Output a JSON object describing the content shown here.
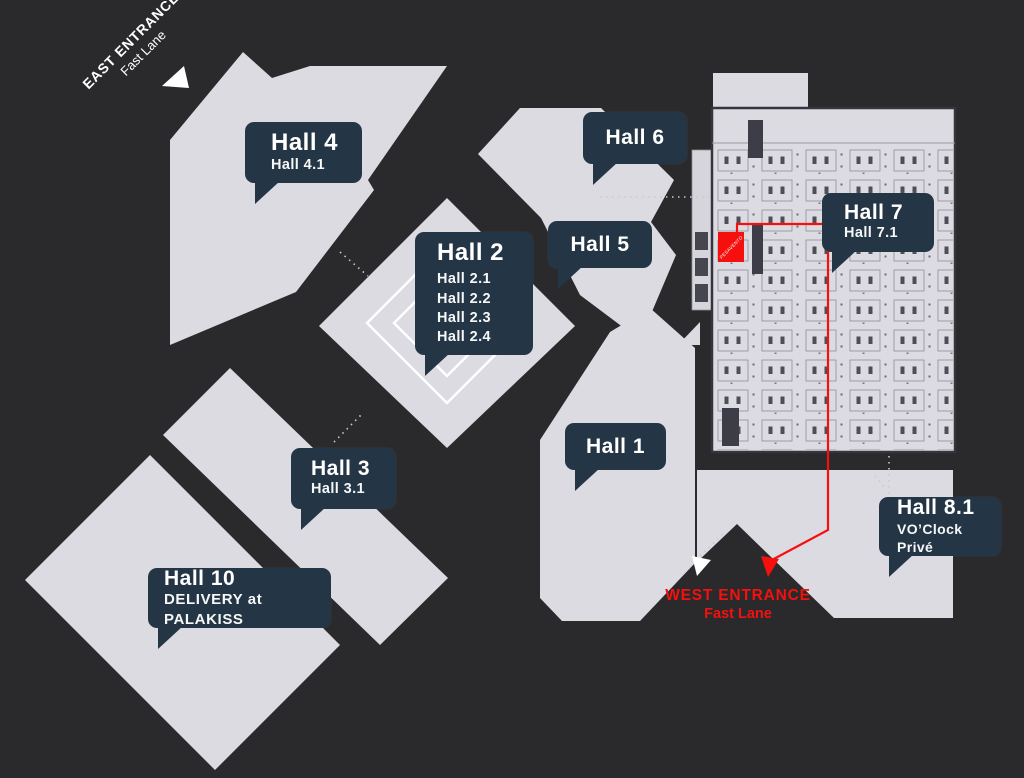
{
  "map": {
    "title": "Exhibition venue hall map",
    "colors": {
      "background": "#2a2a2c",
      "hall_fill": "#dcdbe1",
      "callout_bg": "#243646",
      "accent_red": "#f5100d",
      "text_white": "#ffffff"
    },
    "halls": [
      {
        "id": "hall4",
        "title": "Hall 4",
        "subtitles": [
          "Hall 4.1"
        ]
      },
      {
        "id": "hall2",
        "title": "Hall 2",
        "subtitles": [
          "Hall 2.1",
          "Hall 2.2",
          "Hall 2.3",
          "Hall 2.4"
        ]
      },
      {
        "id": "hall6",
        "title": "Hall 6",
        "subtitles": []
      },
      {
        "id": "hall5",
        "title": "Hall 5",
        "subtitles": []
      },
      {
        "id": "hall7",
        "title": "Hall 7",
        "subtitles": [
          "Hall 7.1"
        ]
      },
      {
        "id": "hall1",
        "title": "Hall 1",
        "subtitles": []
      },
      {
        "id": "hall3",
        "title": "Hall 3",
        "subtitles": [
          "Hall 3.1"
        ]
      },
      {
        "id": "hall81",
        "title": "Hall 8.1",
        "subtitles": [
          "VO’Clock Privé"
        ]
      },
      {
        "id": "hall10",
        "title": "Hall 10",
        "subtitles": [
          "DELIVERY at PALAKISS"
        ]
      }
    ],
    "entrances": {
      "east": {
        "line1": "EAST ENTRANCE",
        "line2": "Fast Lane"
      },
      "west": {
        "line1": "WEST ENTRANCE",
        "line2": "Fast Lane"
      }
    },
    "marker": {
      "label": "PESAVENTO"
    }
  }
}
